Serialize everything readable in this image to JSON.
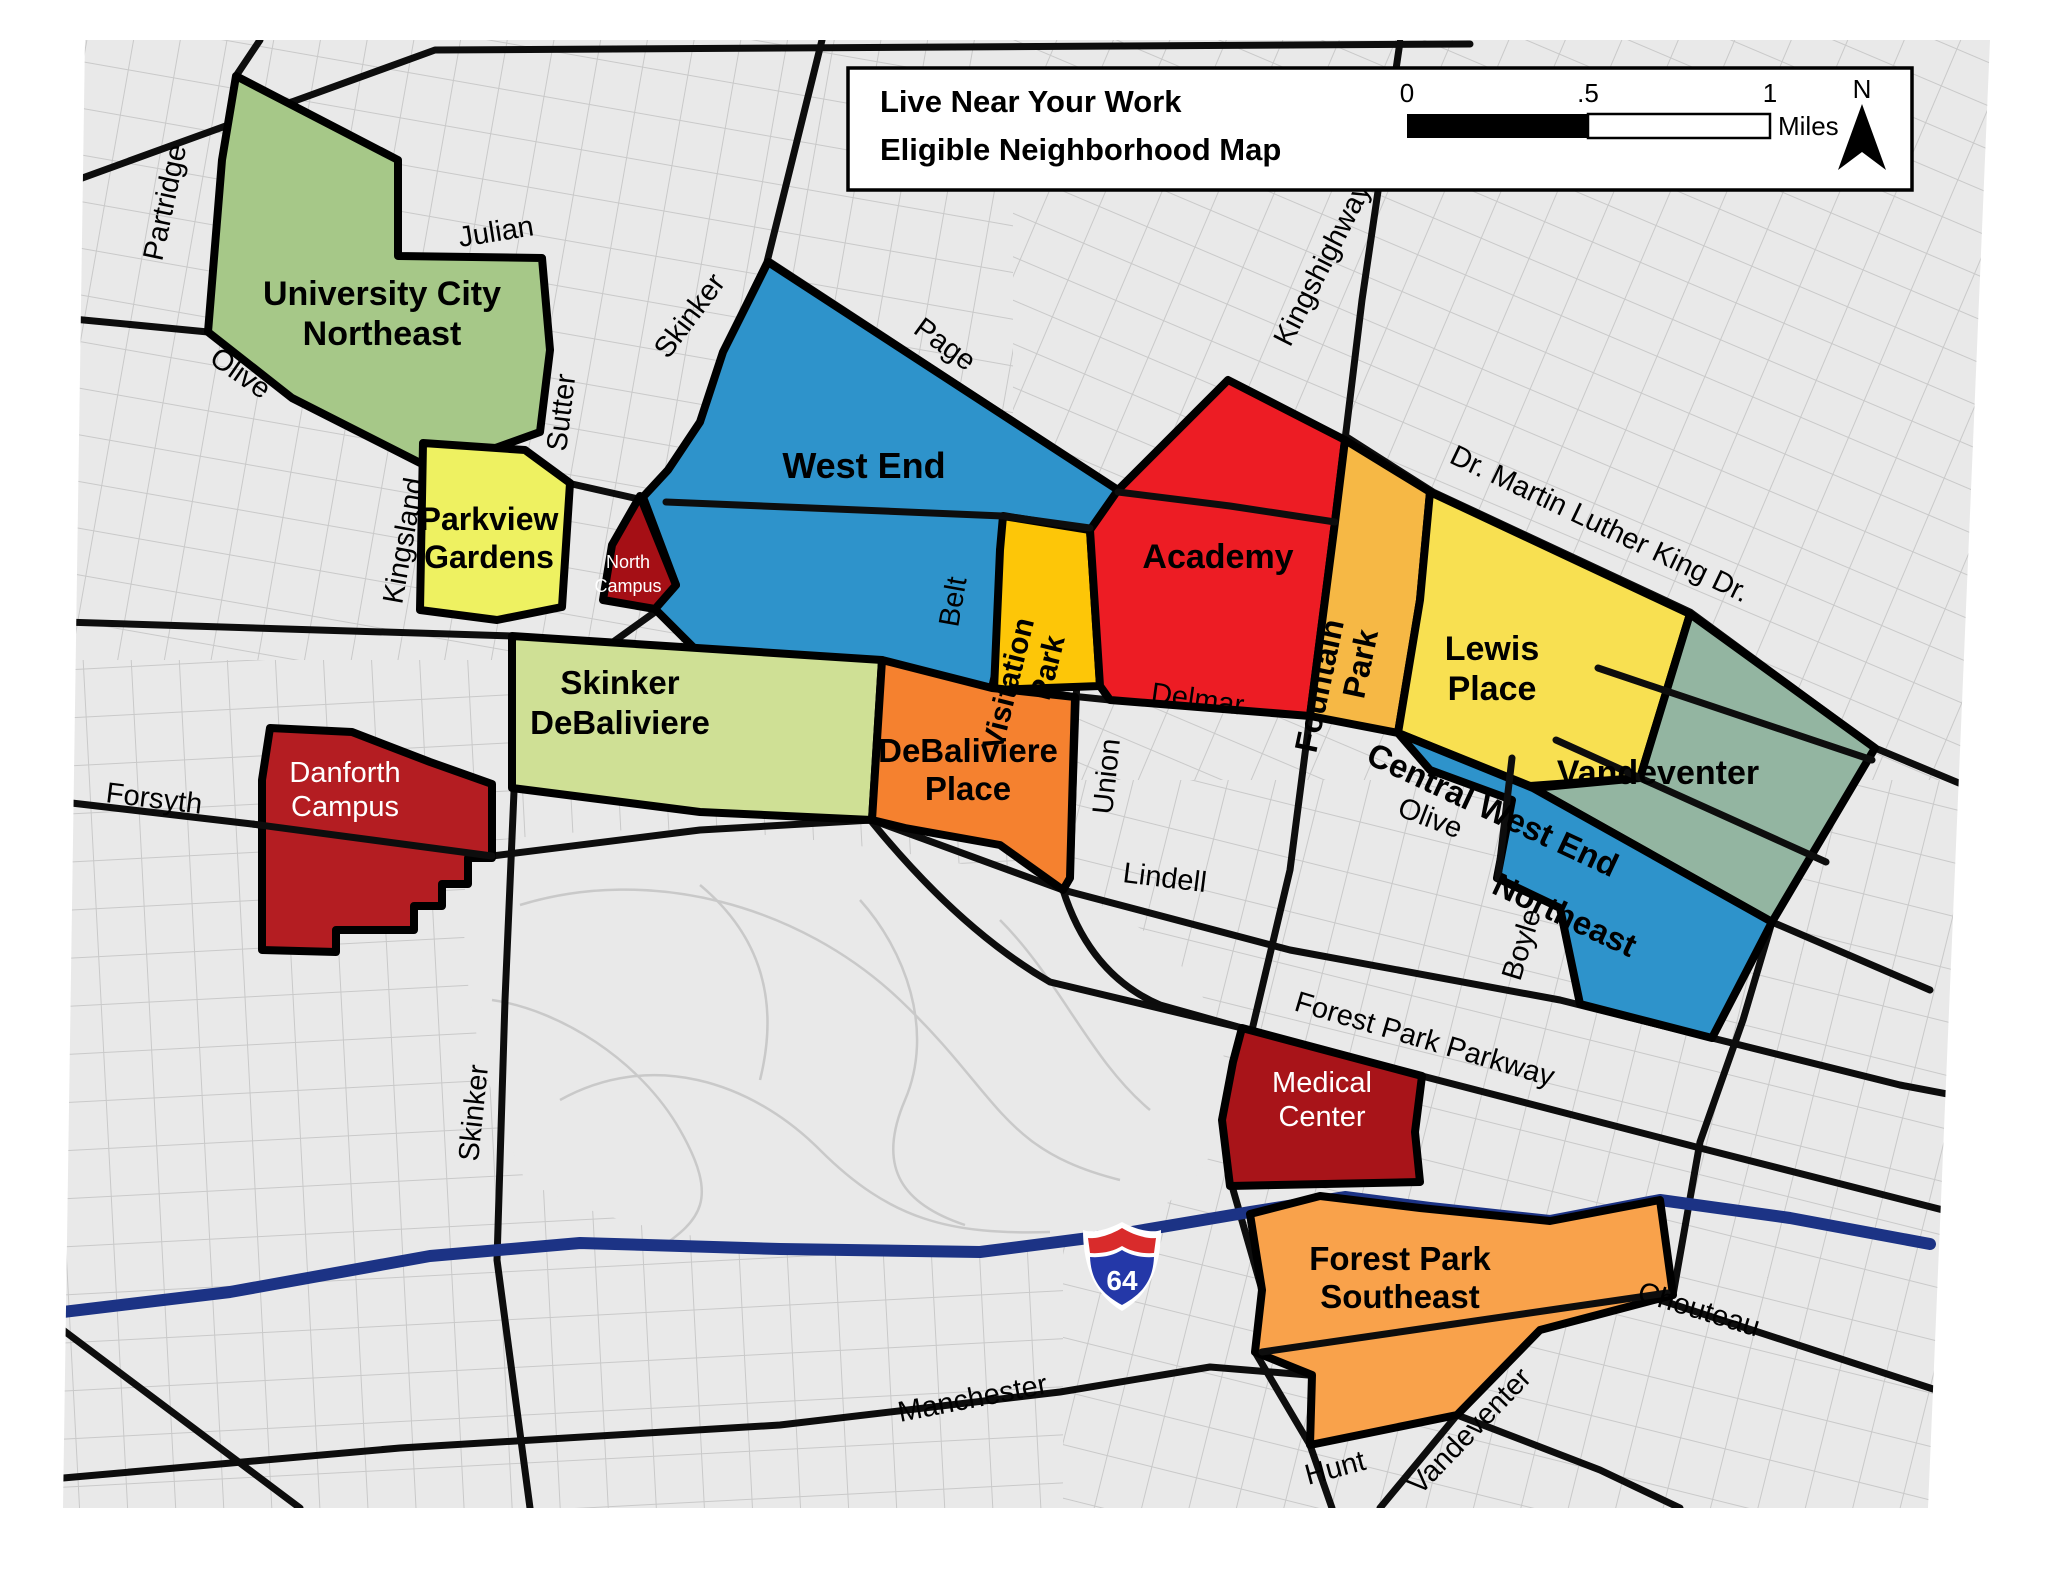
{
  "legend": {
    "title_line1": "Live Near Your Work",
    "title_line2": "Eligible Neighborhood Map",
    "scale_start": "0",
    "scale_mid": ".5",
    "scale_end": "1",
    "scale_unit": "Miles",
    "north": "N"
  },
  "highway_shield": "64",
  "colors": {
    "map_background": "#e9e9e9",
    "minor_street": "#c9c9c9",
    "major_road": "#0d0d0d",
    "interstate": "#1c3385"
  },
  "regions": {
    "university_city_northeast": {
      "name": "University City Northeast",
      "lines": [
        "University City",
        "Northeast"
      ],
      "color": "#a6c888"
    },
    "parkview_gardens": {
      "name": "Parkview Gardens",
      "lines": [
        "Parkview",
        "Gardens"
      ],
      "color": "#eef161"
    },
    "north_campus": {
      "name": "North Campus",
      "lines": [
        "North",
        "Campus"
      ],
      "color": "#a50f15",
      "text_color": "#ffffff"
    },
    "west_end": {
      "name": "West End",
      "lines": [
        "West End"
      ],
      "color": "#2e93cb"
    },
    "visitation_park": {
      "name": "Visitation Park",
      "lines": [
        "Visitation",
        "Park"
      ],
      "color": "#fdc608"
    },
    "academy": {
      "name": "Academy",
      "lines": [
        "Academy"
      ],
      "color": "#ed1c24"
    },
    "fountain_park": {
      "name": "Fountain Park",
      "lines": [
        "Fountain",
        "Park"
      ],
      "color": "#f6b845"
    },
    "lewis_place": {
      "name": "Lewis Place",
      "lines": [
        "Lewis",
        "Place"
      ],
      "color": "#f8e051"
    },
    "vandeventer": {
      "name": "Vandeventer",
      "lines": [
        "Vandeventer"
      ],
      "color": "#93b5a1"
    },
    "central_west_end_northeast": {
      "name": "Central West End Northeast",
      "lines": [
        "Central West End",
        "Northeast"
      ],
      "color": "#2e93cb"
    },
    "skinker_debaliviere": {
      "name": "Skinker DeBaliviere",
      "lines": [
        "Skinker",
        "DeBaliviere"
      ],
      "color": "#cfe095"
    },
    "debaliviere_place": {
      "name": "DeBaliviere Place",
      "lines": [
        "DeBaliviere",
        "Place"
      ],
      "color": "#f5812f"
    },
    "danforth_campus": {
      "name": "Danforth Campus",
      "lines": [
        "Danforth",
        "Campus"
      ],
      "color": "#b41d22",
      "text_color": "#ffffff"
    },
    "medical_center": {
      "name": "Medical Center",
      "lines": [
        "Medical",
        "Center"
      ],
      "color": "#a81419",
      "text_color": "#ffffff"
    },
    "forest_park_southeast": {
      "name": "Forest Park Southeast",
      "lines": [
        "Forest Park",
        "Southeast"
      ],
      "color": "#f9a24b"
    }
  },
  "streets": {
    "partridge": "Partridge",
    "olive_west": "Olive",
    "julian": "Julian",
    "sutter": "Sutter",
    "kingsland": "Kingsland",
    "skinker_north": "Skinker",
    "page": "Page",
    "belt": "Belt",
    "kingshighway": "Kingshighway",
    "mlk": "Dr. Martin Luther King Dr.",
    "delmar": "Delmar",
    "union": "Union",
    "olive_east": "Olive",
    "boyle": "Boyle",
    "lindell": "Lindell",
    "forsyth": "Forsyth",
    "skinker_south": "Skinker",
    "forest_park_parkway": "Forest Park Parkway",
    "manchester": "Manchester",
    "chouteau": "Chouteau",
    "hunt": "Hunt",
    "vandeventer_street": "Vandeventer"
  }
}
